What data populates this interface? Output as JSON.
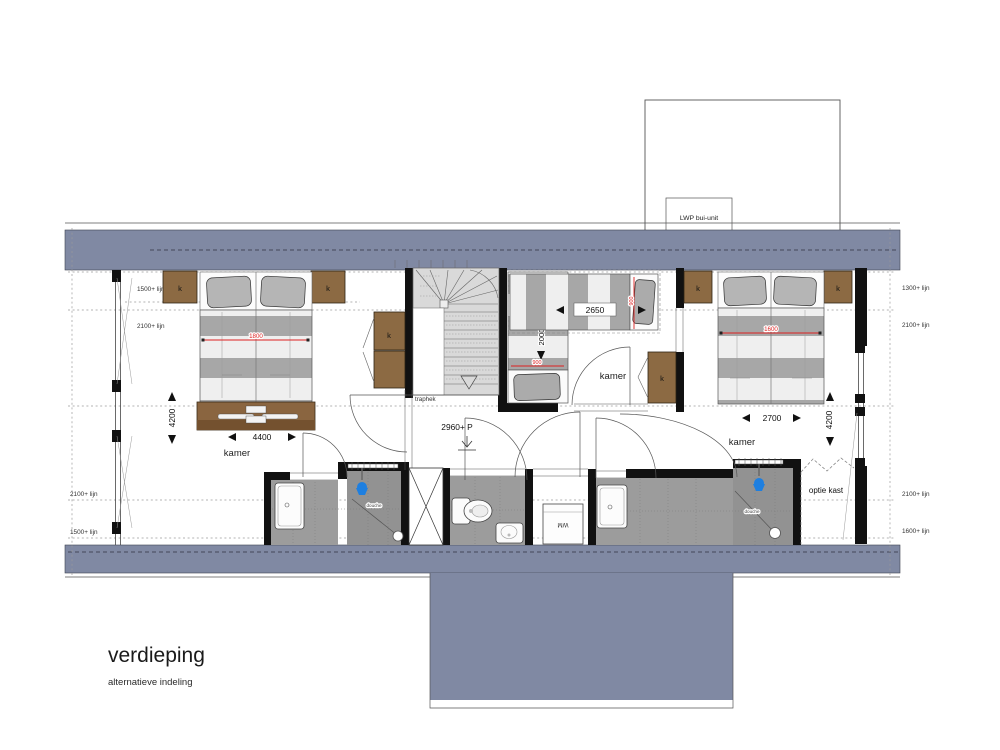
{
  "title": "verdieping",
  "subtitle": "alternatieve indeling",
  "unit_label": "LWP bui-unit",
  "rooms": {
    "left": "kamer",
    "middle": "kamer",
    "right": "kamer",
    "stapelbed": "stapelbed",
    "optie_kast": "optie kast",
    "traphek": "traphek",
    "wm": "WM",
    "douche_left": "douche",
    "douche_right": "douche"
  },
  "closet_label": "k",
  "height_lines": {
    "top_left_1500": "1500+ lijn",
    "top_left_2100": "2100+ lijn",
    "top_right_1300": "1300+ lijn",
    "top_right_2100": "2100+ lijn",
    "bottom_left_2100": "2100+ lijn",
    "bottom_left_1500": "1500+ lijn",
    "bottom_right_2100": "2100+ lijn",
    "bottom_right_1600": "1600+ lijn"
  },
  "dimensions": {
    "left_room_width": "4400",
    "left_room_depth": "4200",
    "right_room_width": "2700",
    "right_room_depth": "4200",
    "single_bed_length": "2650",
    "stapelbed_length": "2000",
    "ceiling_height": "2960+ P",
    "red": {
      "left_bed_width": "1800",
      "right_bed_width": "1600",
      "stapelbed_width": "900",
      "single_bed_width": "900"
    }
  },
  "colors": {
    "slate": "#8089A3",
    "closet": "#8C6A43",
    "dim-red": "#DD2222",
    "shower-blue": "#1E7FE0",
    "wall": "#111111"
  }
}
